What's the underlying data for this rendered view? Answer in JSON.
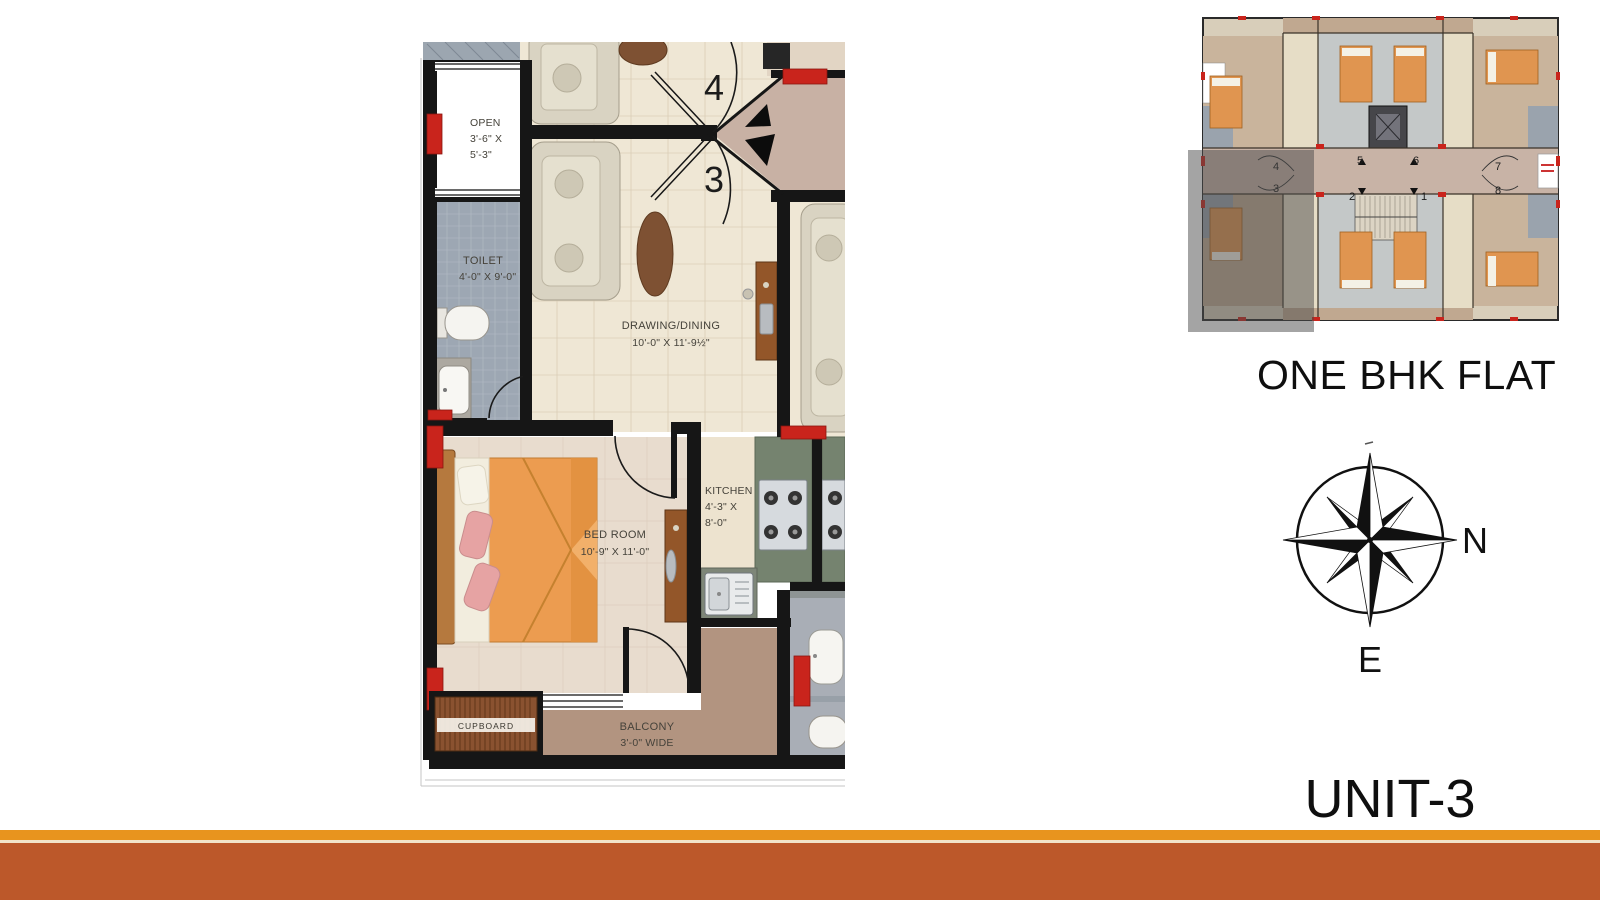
{
  "title": "ONE BHK FLAT",
  "unit_label": "UNIT-3",
  "compass": {
    "north": "N",
    "east": "E"
  },
  "plan": {
    "open": {
      "name": "OPEN",
      "dim1": "3'-6\" X",
      "dim2": "5'-3\""
    },
    "toilet": {
      "name": "TOILET",
      "dims": "4'-0\" X 9'-0\""
    },
    "drawing": {
      "name": "DRAWING/DINING",
      "dims": "10'-0\" X 11'-9½\""
    },
    "bedroom": {
      "name": "BED ROOM",
      "dims": "10'-9\" X 11'-0\""
    },
    "kitchen": {
      "name": "KITCHEN",
      "dim1": "4'-3\" X",
      "dim2": "8'-0\""
    },
    "balcony": {
      "name": "BALCONY",
      "dims": "3'-0\" WIDE"
    },
    "cupboard": {
      "name": "CUPBOARD"
    },
    "entry_doors": {
      "upper": "4",
      "lower": "3"
    }
  },
  "key_plan": {
    "numbers": {
      "u1": "1",
      "u2": "2",
      "u3": "3",
      "u4": "4",
      "u5": "5",
      "u6": "6",
      "u7": "7",
      "u8": "8"
    }
  },
  "colors": {
    "accent_red": "#C9241C",
    "bar_top": "#E8941E",
    "bar_bottom": "#BC582A",
    "drawing_floor": "#EFE7D5",
    "toilet_floor": "#9DA7B3",
    "balcony_floor": "#B29480",
    "kitchen_counter": "#75836F",
    "bed_orange": "#EC9C50"
  }
}
